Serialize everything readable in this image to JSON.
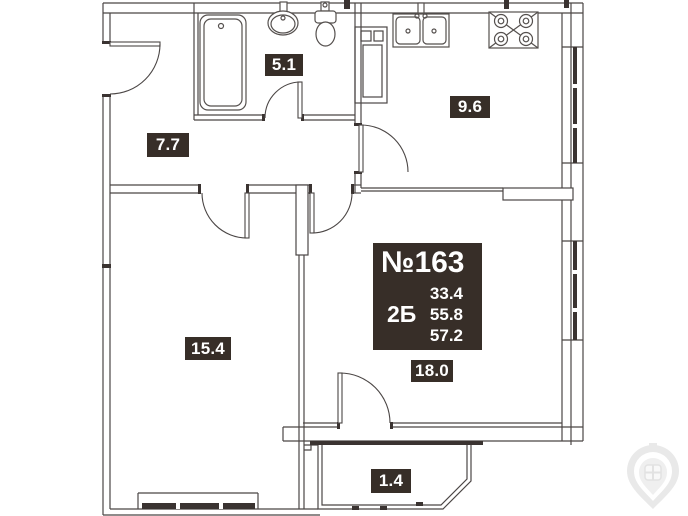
{
  "info_box": {
    "number": "№163",
    "type": "2Б",
    "values": [
      "33.4",
      "55.8",
      "57.2"
    ]
  },
  "rooms": [
    {
      "name": "bathroom",
      "area": "5.1"
    },
    {
      "name": "hallway",
      "area": "7.7"
    },
    {
      "name": "kitchen",
      "area": "9.6"
    },
    {
      "name": "room",
      "area": "15.4"
    },
    {
      "name": "living-room",
      "area": "18.0"
    },
    {
      "name": "balcony",
      "area": "1.4"
    }
  ],
  "icons": {
    "bathtub": "bathtub-icon",
    "wash_basin": "sink-icon",
    "toilet": "toilet-icon",
    "kitchen_sink": "kitchen-sink-icon",
    "stove": "stove-icon",
    "vent_shaft": "ventilation-shaft-icon",
    "watermark": "watermark-logo"
  },
  "colors": {
    "wall": "#4b4645",
    "dark_fill": "#3a3331",
    "label_bg": "#372e28",
    "label_fg": "#ffffff",
    "watermark": "#e9e9e9"
  }
}
